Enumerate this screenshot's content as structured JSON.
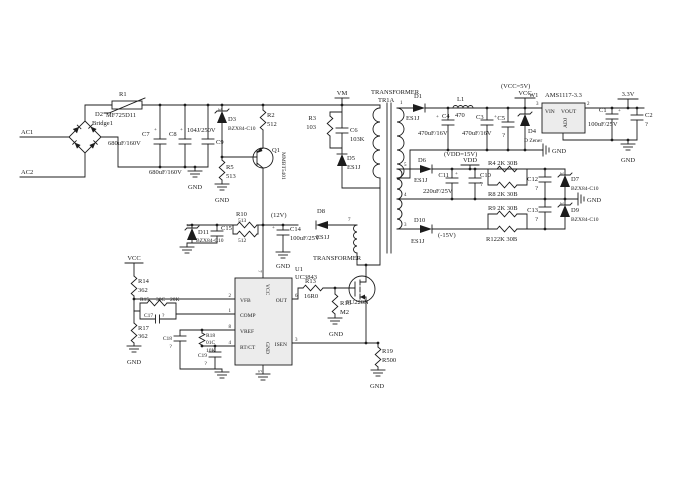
{
  "schematic": {
    "plus": "+",
    "sot_pin3": "3",
    "nets": {
      "ac1": "AC1",
      "ac2": "AC2",
      "vm": "VM",
      "vcc": "VCC",
      "vcc_5v": "(VCC=5V)",
      "v3_3": "3.3V",
      "vdd": "VDD",
      "vdd_15v": "(VDD=15V)",
      "v12": "(12V)",
      "neg15": "(-15V)",
      "gnd": "GND"
    },
    "transformer": {
      "name": "TRANSFORMER",
      "ref": "TR1A",
      "name2": "TRANSFORMER",
      "pin1": "1",
      "pin3": "3",
      "pin4": "4",
      "pin5": "5",
      "pin7": "7"
    },
    "components": {
      "r1": {
        "ref": "R1",
        "value": "MF725D11"
      },
      "r2": {
        "ref": "R2",
        "value": "512"
      },
      "r3": {
        "ref": "R3",
        "value": "103"
      },
      "r4": {
        "label": "R4 2K 30B"
      },
      "r5": {
        "ref": "R5",
        "value": "513"
      },
      "r8": {
        "label": "R8 2K 30B"
      },
      "r9": {
        "label": "R9 2K 30B"
      },
      "r10": {
        "ref": "R10",
        "value": "513"
      },
      "r11": {
        "value": "512"
      },
      "r12": {
        "label": "R122K 30B"
      },
      "r13": {
        "ref": "R13",
        "value": "16R0"
      },
      "r14": {
        "ref": "R14",
        "value": "362"
      },
      "r15": {
        "ref": "R15",
        "code": "30C",
        "value": "20K"
      },
      "r16": {
        "ref": "R16",
        "value": "M2"
      },
      "r17": {
        "ref": "R17",
        "value": "362"
      },
      "r18": {
        "ref": "R18",
        "code": "01C",
        "value": "10K"
      },
      "r19": {
        "ref": "R19",
        "value": "R500"
      },
      "c1": {
        "ref": "C1",
        "value": "100uF/25V"
      },
      "c2": {
        "ref": "C2",
        "value": "?"
      },
      "c3": {
        "ref": "C3",
        "value": "470uF/16V"
      },
      "c4": {
        "ref": "C4",
        "value": "470uF/16V"
      },
      "c5": {
        "ref": "C5",
        "value": "?"
      },
      "c6": {
        "ref": "C6",
        "value": "103K"
      },
      "c7": {
        "ref": "C7",
        "value": "680uF/160V"
      },
      "c8": {
        "ref": "C8",
        "value": "680uF/160V"
      },
      "c9": {
        "ref": "C9",
        "value": "104J/250V"
      },
      "c10": {
        "ref": "C10",
        "value": "?"
      },
      "c11": {
        "ref": "C11",
        "value": "220uF/25V"
      },
      "c12": {
        "ref": "C12",
        "value": "?"
      },
      "c13": {
        "ref": "C13",
        "value": "?"
      },
      "c14": {
        "ref": "C14",
        "value": "100uF/25V"
      },
      "c15": {
        "ref": "C15"
      },
      "c17": {
        "ref": "C17",
        "value": "?"
      },
      "c18": {
        "ref": "C18",
        "value": "?"
      },
      "c19": {
        "ref": "C19",
        "value": "?"
      },
      "d1": {
        "ref": "D1",
        "part": "ES1J"
      },
      "d2": {
        "ref": "D2",
        "part": "Bridge1"
      },
      "d3": {
        "ref": "D3",
        "part": "BZX84-C10"
      },
      "d4": {
        "ref": "D4",
        "part": "D Zener"
      },
      "d5": {
        "ref": "D5",
        "part": "ES1J"
      },
      "d6": {
        "ref": "D6",
        "part": "ES1J"
      },
      "d7": {
        "ref": "D7",
        "part": "BZX84-C10"
      },
      "d8": {
        "ref": "D8",
        "part": "ES1J"
      },
      "d9": {
        "ref": "D9",
        "part": "BZX84-C10"
      },
      "d10": {
        "ref": "D10",
        "part": "ES1J"
      },
      "d11": {
        "ref": "D11",
        "part": "BZX84-C10"
      },
      "l1": {
        "ref": "L1",
        "value": "470"
      },
      "q1": {
        "ref": "Q1",
        "part": "MMBT5401"
      },
      "q2": {
        "part": "FU220N"
      }
    },
    "u1": {
      "ref": "U1",
      "part": "UC3843",
      "pin_vfb": "VFB",
      "pin_comp": "COMP",
      "pin_vref": "VREF",
      "pin_rtct": "RT/CT",
      "pin_out": "OUT",
      "pin_isen": "ISEN",
      "pin_vcc": "VCC",
      "pin_gnd": "GND",
      "n1": "1",
      "n2": "2",
      "n3": "3",
      "n4": "4",
      "n5": "5",
      "n6": "6",
      "n7": "7",
      "n8": "8"
    },
    "w1": {
      "ref": "W1",
      "part": "AMS1117-3.3",
      "pin_vin": "VIN",
      "pin_vout": "VOUT",
      "pin_adj": "ADJ",
      "n2": "2",
      "n3": "3"
    }
  }
}
